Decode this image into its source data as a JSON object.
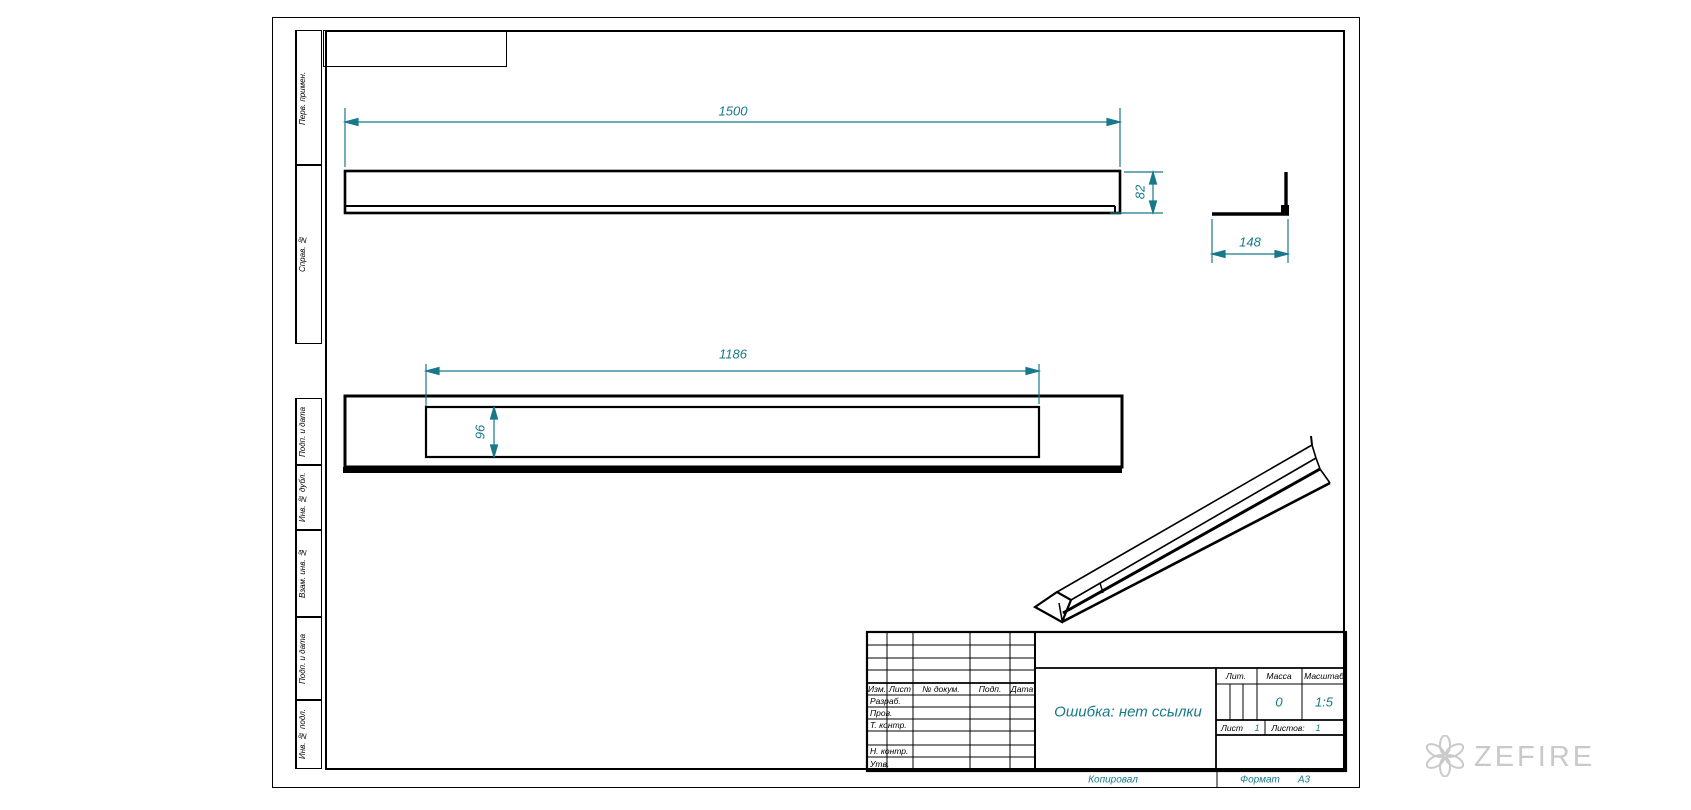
{
  "drawing": {
    "dims": {
      "side_length": "1500",
      "side_height": "82",
      "end_width": "148",
      "slot_length": "1186",
      "slot_width": "96"
    },
    "margin_labels": [
      "Перв. примен.",
      "Справ. №",
      "Подп. и дата",
      "Инв. № дубл.",
      "Взам. инв. №",
      "Подп. и дата",
      "Инв. № подл."
    ],
    "title_block": {
      "doc_name": "Ошибка: нет ссылки",
      "col_izm": "Изм.",
      "col_list": "Лист",
      "col_docnum": "№ докум.",
      "col_podp": "Подп.",
      "col_data": "Дата",
      "row_razrab": "Разраб.",
      "row_prov": "Пров.",
      "row_tkontr": "Т. контр.",
      "row_nkontr": "Н. контр.",
      "row_utv": "Утв.",
      "lit_label": "Лит.",
      "mass_label": "Масса",
      "scale_label": "Масштаб",
      "mass_value": "0",
      "scale_value": "1:5",
      "sheet_label": "Лист",
      "sheet_value": "1",
      "sheets_label": "Листов:",
      "sheets_value": "1"
    },
    "footer": {
      "copied": "Копировал",
      "format_label": "Формат",
      "format_value": "А3"
    },
    "watermark_text": "ZEFIRE",
    "colors": {
      "dimension": "#17798a",
      "line": "#000000",
      "watermark": "#c9c9c9"
    }
  }
}
